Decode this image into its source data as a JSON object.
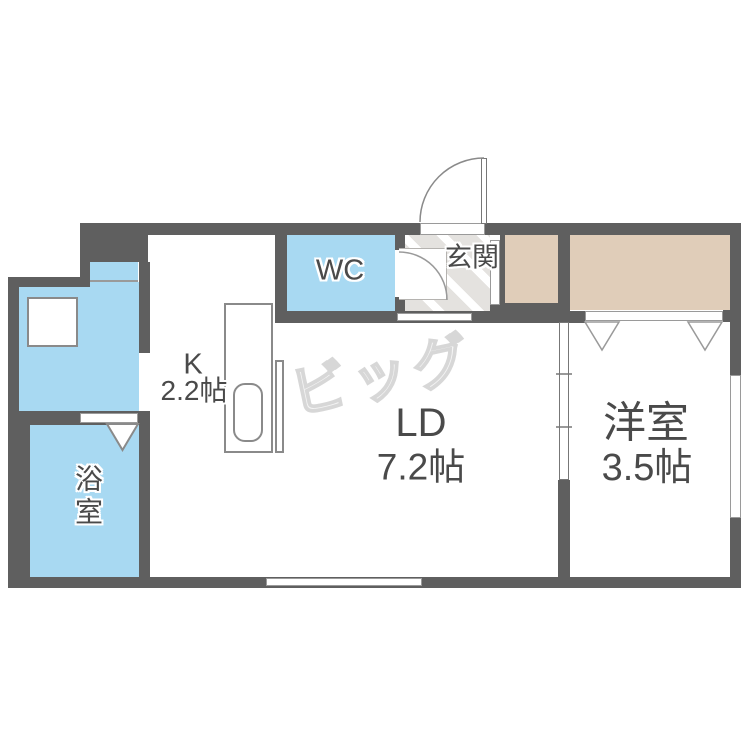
{
  "plan_title": "1LDK apartment floor plan",
  "colors": {
    "wall": "#5f5f5f",
    "water_blue": "#a8d9f2",
    "closet_beige": "#e0cdb9",
    "entrance_gray": "#e4e2df",
    "label_gray": "#4a4a4a",
    "fixture_border": "#8a8a8a",
    "logo_gray": "#d7d7d7"
  },
  "rooms": {
    "living_dining": {
      "name": "LD",
      "area": "7.2帖"
    },
    "kitchen": {
      "name": "K",
      "area": "2.2帖"
    },
    "western_room": {
      "name": "洋室",
      "area": "3.5帖"
    },
    "wc": {
      "name": "WC"
    },
    "bathroom": {
      "name": "浴室"
    },
    "entrance": {
      "name": "玄関"
    }
  },
  "watermark": {
    "text": "ビッグ"
  }
}
